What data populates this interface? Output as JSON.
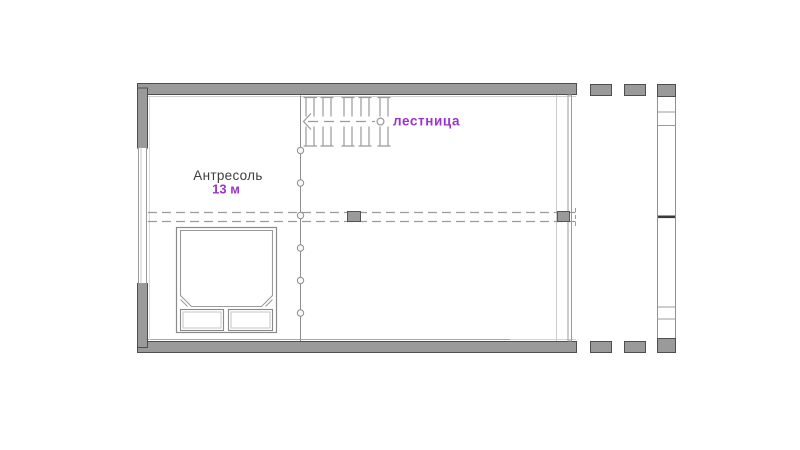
{
  "canvas": {
    "width": 800,
    "height": 450,
    "background": "#ffffff"
  },
  "floor_plan": {
    "room": {
      "name": "Антресоль",
      "area": "13 м"
    },
    "stairs": {
      "label": "лестница"
    },
    "colors": {
      "wall_fill": "#9a9a9a",
      "wall_outline": "#4e4e4e",
      "drawing_line": "#999999",
      "light_line": "#d2d2d2",
      "accent_purple": "#9c33cc",
      "label_text": "#3d3d3d"
    }
  }
}
